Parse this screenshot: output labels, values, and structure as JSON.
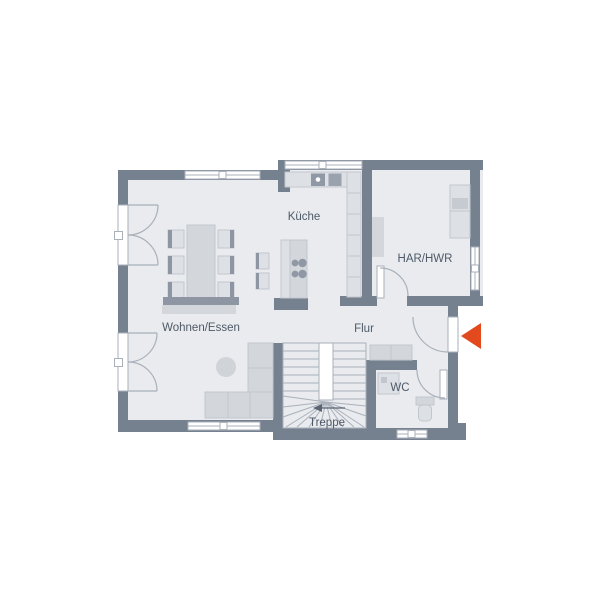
{
  "rooms": {
    "kueche": {
      "label": "Küche"
    },
    "har_hwr": {
      "label": "HAR/HWR"
    },
    "wohnen_essen": {
      "label": "Wohnen/Essen"
    },
    "flur": {
      "label": "Flur"
    },
    "wc": {
      "label": "WC"
    },
    "treppe": {
      "label": "Treppe"
    }
  },
  "icons": {
    "entrance_arrow": "entrance-arrow-icon",
    "stair_direction_arrow": "stair-direction-arrow-icon"
  },
  "colors": {
    "background": "#ffffff",
    "wall": "#76818f",
    "floor": "#e9ebee",
    "furniture_light": "#dde0e5",
    "furniture_mid": "#d3d7dc",
    "furniture_dark": "#8d96a2",
    "outline": "#c2c7ce",
    "line": "#a9b1bb",
    "appliance": "#8f98a4",
    "label_text": "#4e5a68",
    "entrance_arrow": "#e2491d"
  }
}
